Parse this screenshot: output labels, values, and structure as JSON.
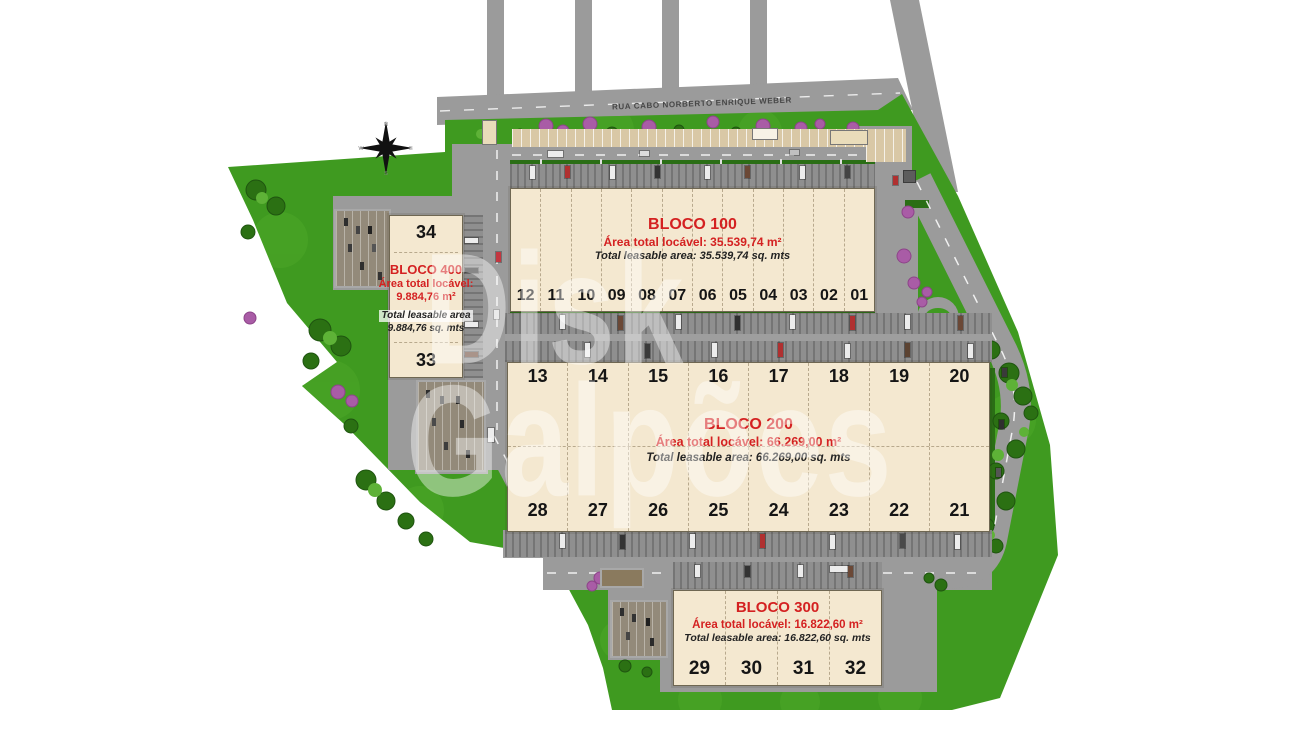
{
  "plan": {
    "street_name": "RUA CABO NORBERTO ENRIQUE WEBER",
    "watermark": {
      "line1": "Disk",
      "line2": "Galpões"
    },
    "compass": {
      "north": "N",
      "south": "S",
      "east": "E",
      "west": "W"
    },
    "colors": {
      "grass": "#3f9a20",
      "pavement": "#9b9b9b",
      "dock": "#8d8d8d",
      "building": "#f4e8d0",
      "accent_red": "#d42121"
    },
    "blocks": {
      "b100": {
        "title": "BLOCO 100",
        "area_pt": "Área total locável: 35.539,74 m²",
        "area_en": "Total leasable area: 35.539,74 sq. mts",
        "units": [
          "12",
          "11",
          "10",
          "09",
          "08",
          "07",
          "06",
          "05",
          "04",
          "03",
          "02",
          "01"
        ]
      },
      "b200": {
        "title": "BLOCO 200",
        "area_pt": "Área total locável: 66.269,00 m²",
        "area_en": "Total leasable area: 66.269,00 sq. mts",
        "units_top": [
          "13",
          "14",
          "15",
          "16",
          "17",
          "18",
          "19",
          "20"
        ],
        "units_bottom": [
          "28",
          "27",
          "26",
          "25",
          "24",
          "23",
          "22",
          "21"
        ]
      },
      "b300": {
        "title": "BLOCO 300",
        "area_pt": "Área total locável: 16.822,60 m²",
        "area_en": "Total leasable area: 16.822,60 sq. mts",
        "units": [
          "29",
          "30",
          "31",
          "32"
        ]
      },
      "b400": {
        "title": "BLOCO 400",
        "area_pt_line1": "Área total locável:",
        "area_pt_line2": "9.884,76 m²",
        "area_en_line1": "Total leasable area",
        "area_en_line2": "9.884,76 sq. mts",
        "unit_top": "34",
        "unit_bottom": "33"
      }
    }
  }
}
